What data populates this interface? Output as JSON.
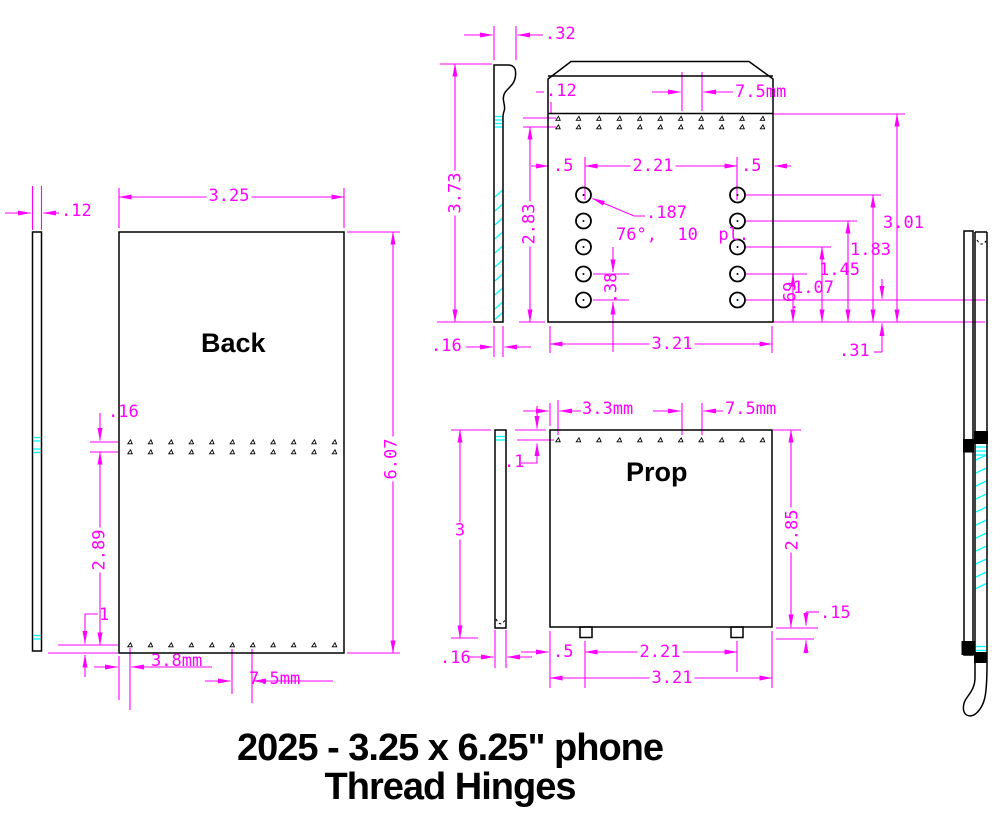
{
  "title": {
    "line1": "2025 - 3.25 x 6.25\" phone",
    "line2": "Thread Hinges"
  },
  "labels": {
    "back_view": "Back",
    "prop_view": "Prop"
  },
  "colors": {
    "dimension": "#ff00ff",
    "geometry": "#000000",
    "thread": "#00ffff",
    "background": "#ffffff"
  },
  "dims": {
    "back": {
      "strip_thickness": ".12",
      "width": "3.25",
      "height": "6.07",
      "row_gap": ".16",
      "row_span": "2.89",
      "bottom_offset": "1",
      "hole_inset": "3.8mm",
      "hole_pitch": "7.5mm"
    },
    "back_side": {
      "hook_depth": ".32",
      "height": "3.73",
      "thickness": ".16"
    },
    "plate": {
      "hole_inset": ".12",
      "hole_pitch": "7.5mm",
      "edge_left": ".5",
      "screw_span": "2.21",
      "edge_right": ".5",
      "screw_dia": ".187",
      "screw_note": "76°,  10  pl.",
      "screw_pitch": ".38",
      "row_height": "2.83",
      "width": "3.21",
      "h69": ".69",
      "h107": "1.07",
      "h145": "1.45",
      "h183": "1.83",
      "h301": "3.01",
      "bottom_offset": ".31"
    },
    "prop": {
      "hole_inset": "3.3mm",
      "hole_pitch": "7.5mm",
      "top_offset": ".1",
      "side_height": "3",
      "height": "2.85",
      "foot": ".15",
      "side_thickness": ".16",
      "edge": ".5",
      "feet_span": "2.21",
      "width": "3.21"
    }
  },
  "holes": {
    "back_top_rows": 2,
    "back_row_count": 11,
    "back_bottom_count": 11,
    "plate_row_count": 11,
    "prop_row_count": 11,
    "screw_columns": 2,
    "screws_per_column": 5
  }
}
